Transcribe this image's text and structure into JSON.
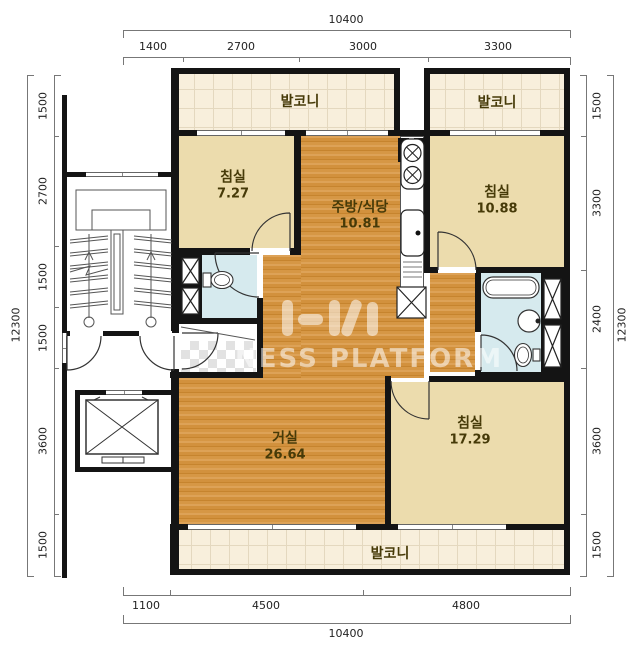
{
  "rooms": {
    "balcony_top_left": {
      "label": "발코니"
    },
    "balcony_top_right": {
      "label": "발코니"
    },
    "balcony_bottom": {
      "label": "발코니"
    },
    "bedroom_top_left": {
      "label": "침실",
      "area": "7.27"
    },
    "kitchen_dining": {
      "label": "주방/식당",
      "area": "10.81"
    },
    "bedroom_top_right": {
      "label": "침실",
      "area": "10.88"
    },
    "living_room": {
      "label": "거실",
      "area": "26.64"
    },
    "bedroom_bottom_right": {
      "label": "침실",
      "area": "17.29"
    }
  },
  "dimensions": {
    "top": {
      "total": "10400",
      "segments": [
        "1400",
        "2700",
        "3000",
        "3300"
      ]
    },
    "bottom": {
      "total": "10400",
      "segments": [
        "1100",
        "4500",
        "4800"
      ]
    },
    "left": {
      "total": "12300",
      "segments": [
        "1500",
        "2700",
        "1500",
        "1500",
        "3600",
        "1500"
      ]
    },
    "right": {
      "total": "12300",
      "segments": [
        "1500",
        "3300",
        "2400",
        "3600",
        "1500"
      ]
    }
  },
  "watermark": {
    "text": "NESS PLATFORM"
  },
  "colors": {
    "wall": "#141414",
    "wood_floor": "#d2913d",
    "bedroom_floor": "#ecdcad",
    "balcony_tile": "#f8efdc",
    "bathroom_floor": "#d6eaee",
    "dimension_text": "#222222"
  }
}
